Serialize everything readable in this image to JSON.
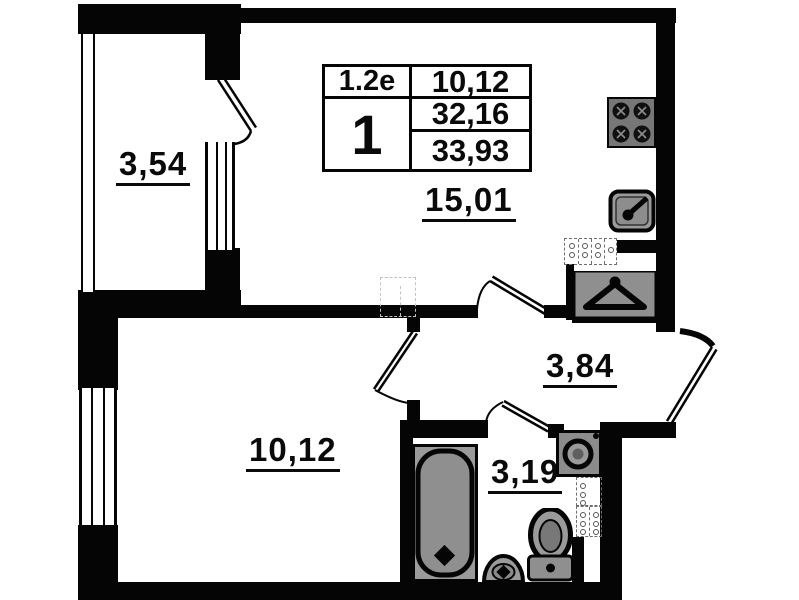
{
  "plan": {
    "legend": {
      "unit_type": "1.2e",
      "room_count": "1",
      "living_area": "10,12",
      "area_without_balcony": "32,16",
      "total_area": "33,93"
    },
    "rooms": {
      "balcony": {
        "label": "3,54"
      },
      "living_room": {
        "label": "15,01"
      },
      "hallway": {
        "label": "3,84"
      },
      "bedroom": {
        "label": "10,12"
      },
      "bathroom": {
        "label": "3,19"
      }
    },
    "fixtures": {
      "stove": "stove-icon",
      "kitchen_sink": "kitchen-sink-icon",
      "wardrobe": "hanger-icon",
      "washing_machine": "washing-machine-icon",
      "bathtub": "bathtub-icon",
      "pedestal_sink": "pedestal-sink-icon",
      "toilet": "toilet-icon"
    },
    "colors": {
      "wall": "#050505",
      "fixture_gray": "#8f8f8f",
      "background": "#ffffff"
    }
  }
}
